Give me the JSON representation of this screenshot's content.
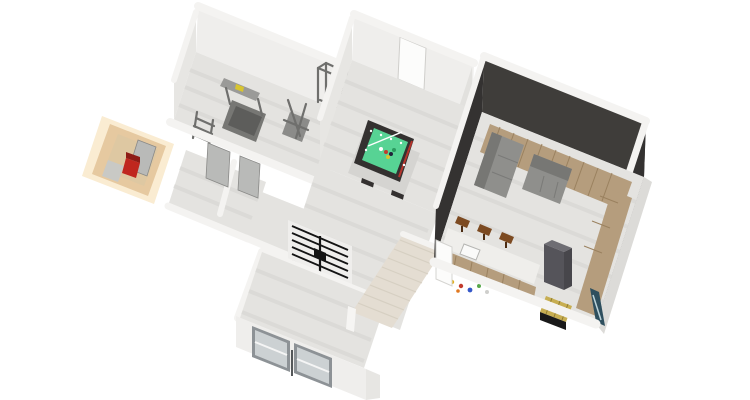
{
  "scene": {
    "type": "isometric-3d-floorplan-render",
    "level": "basement",
    "visible_text": "none",
    "rooms": [
      {
        "name": "gym",
        "wall_color": "#efeeec",
        "furniture": [
          "treadmill",
          "weight-bench",
          "power-rack",
          "dumbbell-rack"
        ]
      },
      {
        "name": "sauna",
        "wall_color": "#e6c9a0",
        "furniture": [
          "sauna-heater",
          "sauna-bench",
          "leaning-door-panel"
        ]
      },
      {
        "name": "closets",
        "furniture": [
          "gray-door",
          "gray-door"
        ]
      },
      {
        "name": "games-room",
        "wall_color": "#efeeec",
        "furniture": [
          "pool-table",
          "white-door"
        ]
      },
      {
        "name": "hallway",
        "furniture": [
          "stair-railing",
          "staircase",
          "low-wall"
        ]
      },
      {
        "name": "entrance-room",
        "furniture": [
          "glass-sliding-door",
          "glass-sliding-door"
        ]
      },
      {
        "name": "lounge-bar",
        "wall_color": "#3f3d3a",
        "furniture": [
          "wood-platform",
          "sofa",
          "sofa",
          "bar-counter",
          "sink",
          "bar-stool",
          "bar-stool",
          "bar-stool",
          "tall-cabinet",
          "floor-toys",
          "toy-chest",
          "wall-board",
          "white-door"
        ]
      }
    ]
  },
  "colors": {
    "background": "#ffffff",
    "wall_top": "#f4f3f1",
    "wall_face": "#efeeec",
    "wall_face_side": "#e7e6e3",
    "wall_face_shadow": "#e2e1de",
    "outer_face": "#dcdbd8",
    "floor": "#e4e3e0",
    "floor_stripe": "#d8d7d4",
    "dark_wall": "#3f3d3a",
    "dark_wall_side": "#343231",
    "wood": "#b59d7d",
    "wood_line": "#9a815f",
    "sofa": "#8f8f8c",
    "sofa_back": "#777774",
    "sauna_glow": "#faecd2",
    "sauna_wall": "#e6c9a0",
    "sauna_floor": "#dec8a2",
    "heater_red": "#c0271f",
    "heater_dark": "#8e1c16",
    "pool_frame": "#343130",
    "pool_felt": "#57d394",
    "pool_red": "#b5342c",
    "stool": "#7c4a21",
    "stool_leg": "#4c2c12",
    "counter_top": "#efeeeb",
    "cabinet": "#55545a",
    "cabinet_top": "#6e6d73",
    "stairs_base": "#e4ddd2",
    "stairs_tread": "#eae3d8",
    "stairs_line": "#d6cfc2",
    "railing_black": "#141414",
    "glass": "#ccd1d3",
    "glass_frame": "#8d9296",
    "door_gray": "#b9bab8",
    "door_white": "#fcfcfb",
    "gold": "#c7ae52",
    "gold_line": "#8e7a2e",
    "board_teal": "#2e4f5e",
    "board_streak": "#bcd3da",
    "equip_shadow": "#d5d4d1",
    "accent_yellow": "#d8c52f",
    "white": "#fafaf9",
    "toy_colors": [
      "#e0b020",
      "#c23b2e",
      "#3558c9",
      "#58a84a",
      "#e07820",
      "#cfcfcc"
    ]
  }
}
